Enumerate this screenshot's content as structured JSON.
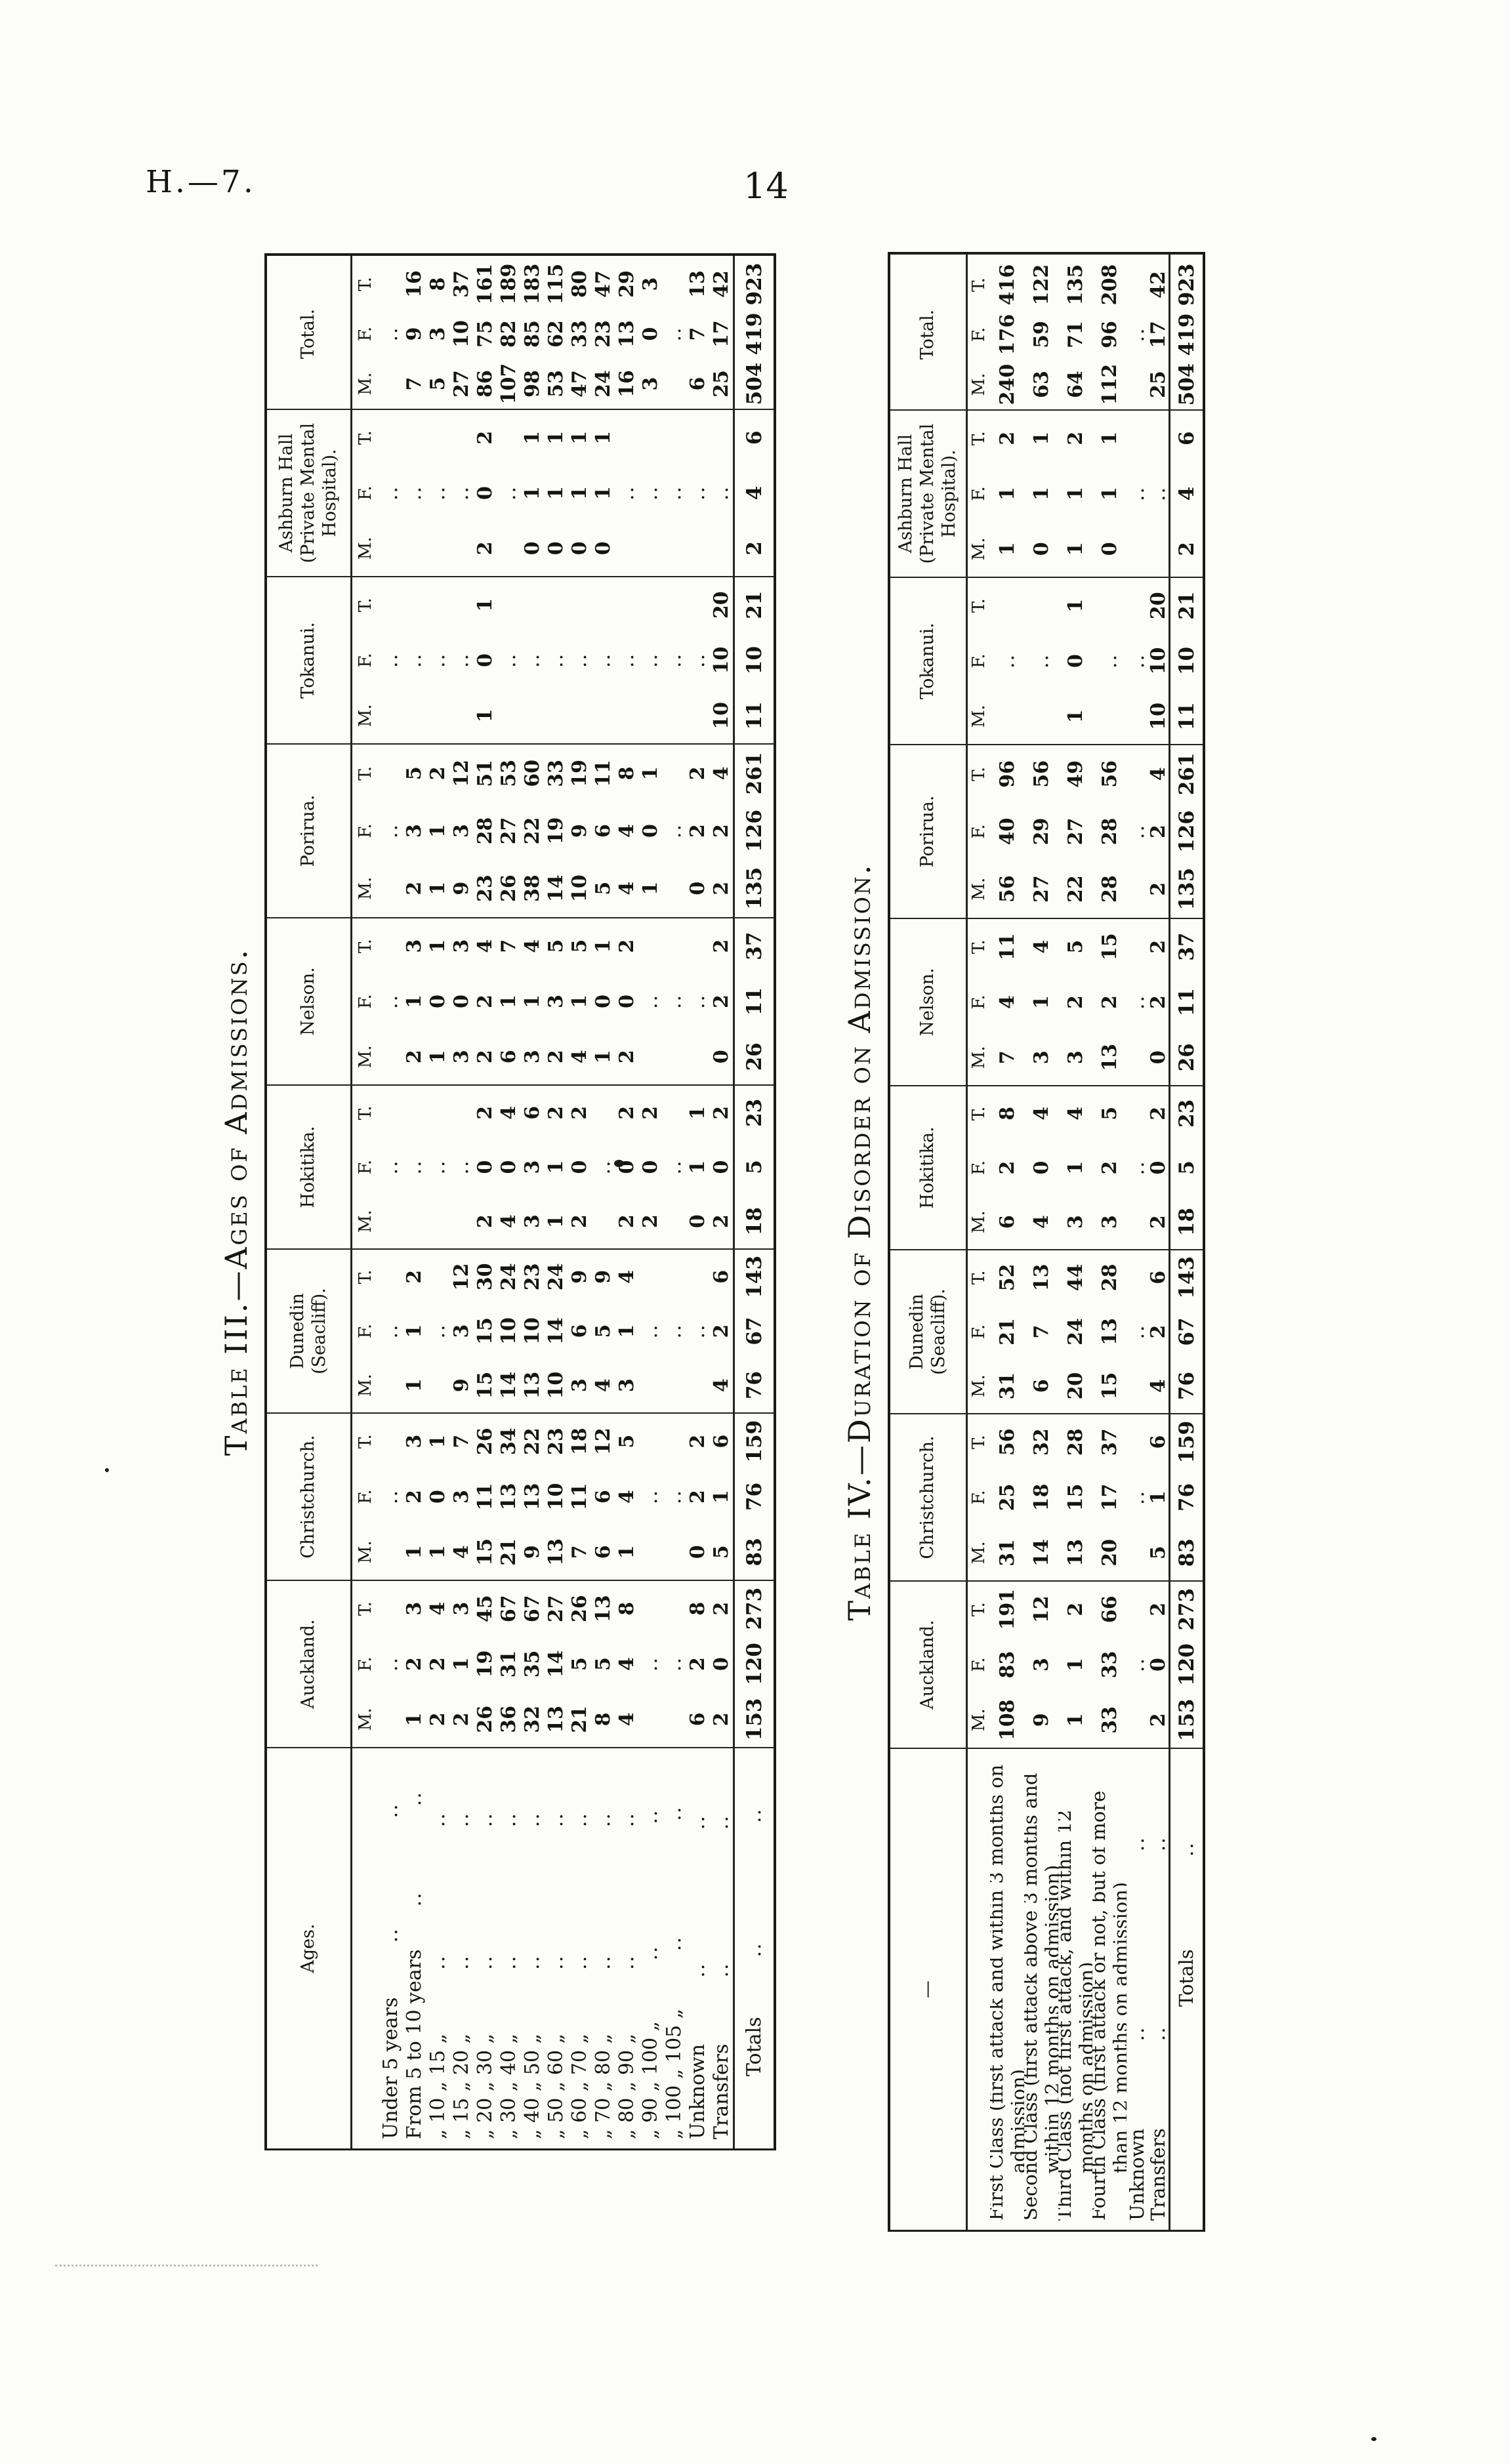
{
  "page": {
    "doc_ref": "H.—7.",
    "page_number": "14"
  },
  "subcolumns": [
    "M.",
    "F.",
    "T."
  ],
  "table3": {
    "title": "Table III.—Ages of Admissions.",
    "stub_header": "Ages.",
    "columns": [
      "Auckland.",
      "Christchurch.",
      "Dunedin (Seacliff).",
      "Hokitika.",
      "Nelson.",
      "Porirua.",
      "Tokanui.",
      "Ashburn Hall (Private Mental Hospital).",
      "Total."
    ],
    "rows": [
      {
        "label": "Under 5 years",
        "leaders": 2,
        "cells": [
          [
            "",
            "..",
            ""
          ],
          [
            "",
            "..",
            ""
          ],
          [
            "",
            "..",
            ""
          ],
          [
            "",
            "..",
            ""
          ],
          [
            "",
            "..",
            ""
          ],
          [
            "",
            "..",
            ""
          ],
          [
            "",
            "..",
            ""
          ],
          [
            "",
            "..",
            ""
          ],
          [
            "",
            "..",
            ""
          ]
        ]
      },
      {
        "label": "From 5 to 10 years",
        "leaders": 2,
        "cells": [
          [
            "1",
            "2",
            "3"
          ],
          [
            "1",
            "2",
            "3"
          ],
          [
            "1",
            "1",
            "2"
          ],
          [
            "",
            "..",
            ""
          ],
          [
            "2",
            "1",
            "3"
          ],
          [
            "2",
            "3",
            "5"
          ],
          [
            "",
            "..",
            ""
          ],
          [
            "",
            "..",
            ""
          ],
          [
            "7",
            "9",
            "16"
          ]
        ]
      },
      {
        "label": "„ 10 „ 15 „",
        "leaders": 2,
        "cells": [
          [
            "2",
            "2",
            "4"
          ],
          [
            "1",
            "0",
            "1"
          ],
          [
            "",
            "..",
            ""
          ],
          [
            "",
            "..",
            ""
          ],
          [
            "1",
            "0",
            "1"
          ],
          [
            "1",
            "1",
            "2"
          ],
          [
            "",
            "..",
            ""
          ],
          [
            "",
            "..",
            ""
          ],
          [
            "5",
            "3",
            "8"
          ]
        ]
      },
      {
        "label": "„ 15 „ 20 „",
        "leaders": 2,
        "cells": [
          [
            "2",
            "1",
            "3"
          ],
          [
            "4",
            "3",
            "7"
          ],
          [
            "9",
            "3",
            "12"
          ],
          [
            "",
            "..",
            ""
          ],
          [
            "3",
            "0",
            "3"
          ],
          [
            "9",
            "3",
            "12"
          ],
          [
            "",
            "..",
            ""
          ],
          [
            "",
            "..",
            ""
          ],
          [
            "27",
            "10",
            "37"
          ]
        ]
      },
      {
        "label": "„ 20 „ 30 „",
        "leaders": 2,
        "cells": [
          [
            "26",
            "19",
            "45"
          ],
          [
            "15",
            "11",
            "26"
          ],
          [
            "15",
            "15",
            "30"
          ],
          [
            "2",
            "0",
            "2"
          ],
          [
            "2",
            "2",
            "4"
          ],
          [
            "23",
            "28",
            "51"
          ],
          [
            "1",
            "0",
            "1"
          ],
          [
            "2",
            "0",
            "2"
          ],
          [
            "86",
            "75",
            "161"
          ]
        ]
      },
      {
        "label": "„ 30 „ 40 „",
        "leaders": 2,
        "cells": [
          [
            "36",
            "31",
            "67"
          ],
          [
            "21",
            "13",
            "34"
          ],
          [
            "14",
            "10",
            "24"
          ],
          [
            "4",
            "0",
            "4"
          ],
          [
            "6",
            "1",
            "7"
          ],
          [
            "26",
            "27",
            "53"
          ],
          [
            "",
            "..",
            ""
          ],
          [
            "",
            "..",
            ""
          ],
          [
            "107",
            "82",
            "189"
          ]
        ]
      },
      {
        "label": "„ 40 „ 50 „",
        "leaders": 2,
        "cells": [
          [
            "32",
            "35",
            "67"
          ],
          [
            "9",
            "13",
            "22"
          ],
          [
            "13",
            "10",
            "23"
          ],
          [
            "3",
            "3",
            "6"
          ],
          [
            "3",
            "1",
            "4"
          ],
          [
            "38",
            "22",
            "60"
          ],
          [
            "",
            "..",
            ""
          ],
          [
            "0",
            "1",
            "1"
          ],
          [
            "98",
            "85",
            "183"
          ]
        ]
      },
      {
        "label": "„ 50 „ 60 „",
        "leaders": 2,
        "cells": [
          [
            "13",
            "14",
            "27"
          ],
          [
            "13",
            "10",
            "23"
          ],
          [
            "10",
            "14",
            "24"
          ],
          [
            "1",
            "1",
            "2"
          ],
          [
            "2",
            "3",
            "5"
          ],
          [
            "14",
            "19",
            "33"
          ],
          [
            "",
            "..",
            ""
          ],
          [
            "0",
            "1",
            "1"
          ],
          [
            "53",
            "62",
            "115"
          ]
        ]
      },
      {
        "label": "„ 60 „ 70 „",
        "leaders": 2,
        "cells": [
          [
            "21",
            "5",
            "26"
          ],
          [
            "7",
            "11",
            "18"
          ],
          [
            "3",
            "6",
            "9"
          ],
          [
            "2",
            "0",
            "2"
          ],
          [
            "4",
            "1",
            "5"
          ],
          [
            "10",
            "9",
            "19"
          ],
          [
            "",
            "..",
            ""
          ],
          [
            "0",
            "1",
            "1"
          ],
          [
            "47",
            "33",
            "80"
          ]
        ]
      },
      {
        "label": "„ 70 „ 80 „",
        "leaders": 2,
        "cells": [
          [
            "8",
            "5",
            "13"
          ],
          [
            "6",
            "6",
            "12"
          ],
          [
            "4",
            "5",
            "9"
          ],
          [
            "",
            "..",
            ""
          ],
          [
            "1",
            "0",
            "1"
          ],
          [
            "5",
            "6",
            "11"
          ],
          [
            "",
            "..",
            ""
          ],
          [
            "0",
            "1",
            "1"
          ],
          [
            "24",
            "23",
            "47"
          ]
        ]
      },
      {
        "label": "„ 80 „ 90 „",
        "leaders": 2,
        "cells": [
          [
            "4",
            "4",
            "8"
          ],
          [
            "1",
            "4",
            "5"
          ],
          [
            "3",
            "1",
            "4"
          ],
          [
            "2",
            "0",
            "2"
          ],
          [
            "2",
            "0",
            "2"
          ],
          [
            "4",
            "4",
            "8"
          ],
          [
            "",
            "..",
            ""
          ],
          [
            "",
            "..",
            ""
          ],
          [
            "16",
            "13",
            "29"
          ]
        ]
      },
      {
        "label": "„ 90 „ 100 „",
        "leaders": 2,
        "cells": [
          [
            "",
            "..",
            ""
          ],
          [
            "",
            "..",
            ""
          ],
          [
            "",
            "..",
            ""
          ],
          [
            "2",
            "0",
            "2"
          ],
          [
            "",
            "..",
            ""
          ],
          [
            "1",
            "0",
            "1"
          ],
          [
            "",
            "..",
            ""
          ],
          [
            "",
            "..",
            ""
          ],
          [
            "3",
            "0",
            "3"
          ]
        ]
      },
      {
        "label": "„ 100 „ 105 „",
        "leaders": 2,
        "cells": [
          [
            "",
            "..",
            ""
          ],
          [
            "",
            "..",
            ""
          ],
          [
            "",
            "..",
            ""
          ],
          [
            "",
            "..",
            ""
          ],
          [
            "",
            "..",
            ""
          ],
          [
            "",
            "..",
            ""
          ],
          [
            "",
            "..",
            ""
          ],
          [
            "",
            "..",
            ""
          ],
          [
            "",
            "..",
            ""
          ]
        ]
      },
      {
        "label": "Unknown",
        "leaders": 2,
        "cells": [
          [
            "6",
            "2",
            "8"
          ],
          [
            "0",
            "2",
            "2"
          ],
          [
            "",
            "..",
            ""
          ],
          [
            "0",
            "1",
            "1"
          ],
          [
            "",
            "..",
            ""
          ],
          [
            "0",
            "2",
            "2"
          ],
          [
            "",
            "..",
            ""
          ],
          [
            "",
            "..",
            ""
          ],
          [
            "6",
            "7",
            "13"
          ]
        ]
      },
      {
        "label": "Transfers",
        "leaders": 2,
        "cells": [
          [
            "2",
            "0",
            "2"
          ],
          [
            "5",
            "1",
            "6"
          ],
          [
            "4",
            "2",
            "6"
          ],
          [
            "2",
            "0",
            "2"
          ],
          [
            "0",
            "2",
            "2"
          ],
          [
            "2",
            "2",
            "4"
          ],
          [
            "10",
            "10",
            "20"
          ],
          [
            "",
            "..",
            ""
          ],
          [
            "25",
            "17",
            "42"
          ]
        ]
      }
    ],
    "totals_row": {
      "label": "Totals",
      "leaders": 2,
      "cells": [
        [
          "153",
          "120",
          "273"
        ],
        [
          "83",
          "76",
          "159"
        ],
        [
          "76",
          "67",
          "143"
        ],
        [
          "18",
          "5",
          "23"
        ],
        [
          "26",
          "11",
          "37"
        ],
        [
          "135",
          "126",
          "261"
        ],
        [
          "11",
          "10",
          "21"
        ],
        [
          "2",
          "4",
          "6"
        ],
        [
          "504",
          "419",
          "923"
        ]
      ]
    }
  },
  "table4": {
    "title": "Table IV.—Duration of Disorder on Admission.",
    "stub_header": "—",
    "columns": [
      "Auckland.",
      "Christchurch.",
      "Dunedin (Seacliff).",
      "Hokitika.",
      "Nelson.",
      "Porirua.",
      "Tokanui.",
      "Ashburn Hall (Private Mental Hospital).",
      "Total."
    ],
    "rows": [
      {
        "label": "First Class (first attack and within 3 months on admission)",
        "leaders": 0,
        "cells": [
          [
            "108",
            "83",
            "191"
          ],
          [
            "31",
            "25",
            "56"
          ],
          [
            "31",
            "21",
            "52"
          ],
          [
            "6",
            "2",
            "8"
          ],
          [
            "7",
            "4",
            "11"
          ],
          [
            "56",
            "40",
            "96"
          ],
          [
            "",
            "..",
            ""
          ],
          [
            "1",
            "1",
            "2"
          ],
          [
            "240",
            "176",
            "416"
          ]
        ]
      },
      {
        "label": "Second Class (first attack above 3 months and within 12 months on admission)",
        "leaders": 0,
        "cells": [
          [
            "9",
            "3",
            "12"
          ],
          [
            "14",
            "18",
            "32"
          ],
          [
            "6",
            "7",
            "13"
          ],
          [
            "4",
            "0",
            "4"
          ],
          [
            "3",
            "1",
            "4"
          ],
          [
            "27",
            "29",
            "56"
          ],
          [
            "",
            "..",
            ""
          ],
          [
            "0",
            "1",
            "1"
          ],
          [
            "63",
            "59",
            "122"
          ]
        ]
      },
      {
        "label": "Third Class (not first attack, and within 12 months on admission)",
        "leaders": 0,
        "cells": [
          [
            "1",
            "1",
            "2"
          ],
          [
            "13",
            "15",
            "28"
          ],
          [
            "20",
            "24",
            "44"
          ],
          [
            "3",
            "1",
            "4"
          ],
          [
            "3",
            "2",
            "5"
          ],
          [
            "22",
            "27",
            "49"
          ],
          [
            "1",
            "0",
            "1"
          ],
          [
            "1",
            "1",
            "2"
          ],
          [
            "64",
            "71",
            "135"
          ]
        ]
      },
      {
        "label": "Fourth Class (first attack or not, but of more than 12 months on admission)",
        "leaders": 0,
        "cells": [
          [
            "33",
            "33",
            "66"
          ],
          [
            "20",
            "17",
            "37"
          ],
          [
            "15",
            "13",
            "28"
          ],
          [
            "3",
            "2",
            "5"
          ],
          [
            "13",
            "2",
            "15"
          ],
          [
            "28",
            "28",
            "56"
          ],
          [
            "",
            "..",
            ""
          ],
          [
            "0",
            "1",
            "1"
          ],
          [
            "112",
            "96",
            "208"
          ]
        ]
      },
      {
        "label": "Unknown",
        "leaders": 2,
        "cells": [
          [
            "",
            "..",
            ""
          ],
          [
            "",
            "..",
            ""
          ],
          [
            "",
            "..",
            ""
          ],
          [
            "",
            "..",
            ""
          ],
          [
            "",
            "..",
            ""
          ],
          [
            "",
            "..",
            ""
          ],
          [
            "",
            "..",
            ""
          ],
          [
            "",
            "..",
            ""
          ],
          [
            "",
            "..",
            ""
          ]
        ]
      },
      {
        "label": "Transfers",
        "leaders": 2,
        "cells": [
          [
            "2",
            "0",
            "2"
          ],
          [
            "5",
            "1",
            "6"
          ],
          [
            "4",
            "2",
            "6"
          ],
          [
            "2",
            "0",
            "2"
          ],
          [
            "0",
            "2",
            "2"
          ],
          [
            "2",
            "2",
            "4"
          ],
          [
            "10",
            "10",
            "20"
          ],
          [
            "",
            "..",
            ""
          ],
          [
            "25",
            "17",
            "42"
          ]
        ]
      }
    ],
    "totals_row": {
      "label": "Totals",
      "leaders": 1,
      "cells": [
        [
          "153",
          "120",
          "273"
        ],
        [
          "83",
          "76",
          "159"
        ],
        [
          "76",
          "67",
          "143"
        ],
        [
          "18",
          "5",
          "23"
        ],
        [
          "26",
          "11",
          "37"
        ],
        [
          "135",
          "126",
          "261"
        ],
        [
          "11",
          "10",
          "21"
        ],
        [
          "2",
          "4",
          "6"
        ],
        [
          "504",
          "419",
          "923"
        ]
      ]
    }
  }
}
